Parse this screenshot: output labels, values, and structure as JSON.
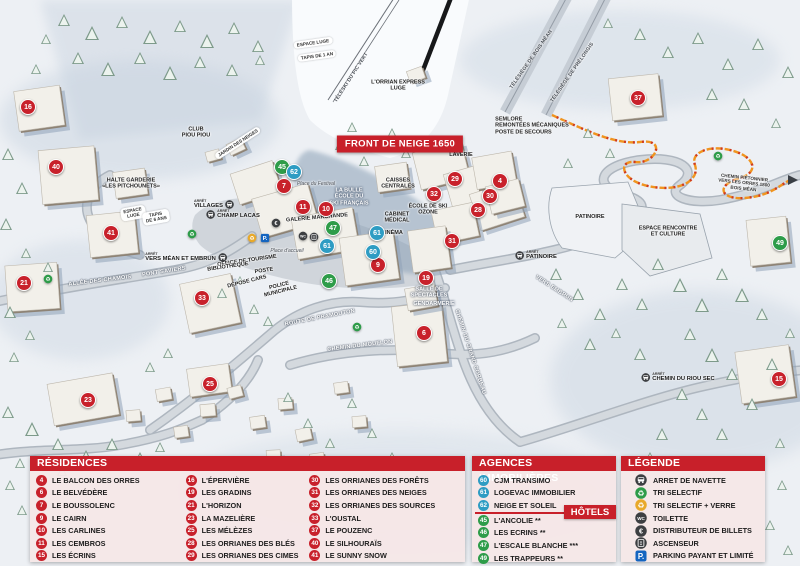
{
  "colors": {
    "residence": "#c8212b",
    "hotel": "#2e9c49",
    "agence": "#2e9cc3",
    "header_red": "#c8202a",
    "path_orange": "#f0941f"
  },
  "map": {
    "banner": "FRONT DE NEIGE 1650",
    "arret_label": "ARRÊT",
    "markers": [
      {
        "n": "16",
        "t": "residence",
        "x": 28,
        "y": 107
      },
      {
        "n": "40",
        "t": "residence",
        "x": 56,
        "y": 167
      },
      {
        "n": "41",
        "t": "residence",
        "x": 111,
        "y": 233
      },
      {
        "n": "21",
        "t": "residence",
        "x": 24,
        "y": 283
      },
      {
        "n": "23",
        "t": "residence",
        "x": 88,
        "y": 400
      },
      {
        "n": "25",
        "t": "residence",
        "x": 210,
        "y": 384
      },
      {
        "n": "33",
        "t": "residence",
        "x": 202,
        "y": 298
      },
      {
        "n": "7",
        "t": "residence",
        "x": 284,
        "y": 186
      },
      {
        "n": "11",
        "t": "residence",
        "x": 303,
        "y": 207
      },
      {
        "n": "10",
        "t": "residence",
        "x": 326,
        "y": 209
      },
      {
        "n": "9",
        "t": "residence",
        "x": 378,
        "y": 265
      },
      {
        "n": "19",
        "t": "residence",
        "x": 426,
        "y": 278
      },
      {
        "n": "6",
        "t": "residence",
        "x": 424,
        "y": 333
      },
      {
        "n": "31",
        "t": "residence",
        "x": 452,
        "y": 241
      },
      {
        "n": "32",
        "t": "residence",
        "x": 434,
        "y": 194
      },
      {
        "n": "29",
        "t": "residence",
        "x": 455,
        "y": 179
      },
      {
        "n": "28",
        "t": "residence",
        "x": 478,
        "y": 210
      },
      {
        "n": "30",
        "t": "residence",
        "x": 490,
        "y": 196
      },
      {
        "n": "4",
        "t": "residence",
        "x": 500,
        "y": 181
      },
      {
        "n": "37",
        "t": "residence",
        "x": 638,
        "y": 98
      },
      {
        "n": "15",
        "t": "residence",
        "x": 779,
        "y": 379
      },
      {
        "n": "45",
        "t": "hotel",
        "x": 282,
        "y": 167
      },
      {
        "n": "47",
        "t": "hotel",
        "x": 333,
        "y": 228
      },
      {
        "n": "46",
        "t": "hotel",
        "x": 329,
        "y": 281
      },
      {
        "n": "49",
        "t": "hotel",
        "x": 780,
        "y": 243
      },
      {
        "n": "62",
        "t": "agence",
        "x": 294,
        "y": 172
      },
      {
        "n": "61",
        "t": "agence",
        "x": 327,
        "y": 246
      },
      {
        "n": "61",
        "t": "agence",
        "x": 377,
        "y": 233
      },
      {
        "n": "60",
        "t": "agence",
        "x": 373,
        "y": 252
      }
    ],
    "labels": [
      {
        "text": "ESPACE LUGE",
        "x": 313,
        "y": 43,
        "r": -8,
        "cls": "pill"
      },
      {
        "text": "TAPIS DE 1 AN",
        "x": 317,
        "y": 56,
        "r": -8,
        "cls": "pill"
      },
      {
        "text": "TÉLÉSKI DU PIC VERT",
        "x": 352,
        "y": 78,
        "r": -57,
        "cls": "lift"
      },
      {
        "text": "L'ORRIAN EXPRESS\nLUGE",
        "x": 398,
        "y": 86,
        "r": 0,
        "cls": "dark"
      },
      {
        "text": "CLUB\nPIOU PIOU",
        "x": 196,
        "y": 133,
        "r": 0,
        "cls": "dark"
      },
      {
        "text": "JARDIN DES NEIGES",
        "x": 238,
        "y": 143,
        "r": -33,
        "cls": "pill"
      },
      {
        "text": "HALTE GARDERIE\n«LES PITCHOUNETS»",
        "x": 131,
        "y": 184,
        "r": 0,
        "cls": "dark"
      },
      {
        "text": "ESPACE\nLUGE",
        "x": 133,
        "y": 213,
        "r": -10,
        "cls": "pill"
      },
      {
        "text": "TAPIS\nDE 6 ANS",
        "x": 156,
        "y": 217,
        "r": -10,
        "cls": "pill"
      },
      {
        "text": "ALLÉE DES CHAMOIS",
        "x": 100,
        "y": 281,
        "r": -7,
        "cls": "road"
      },
      {
        "text": "PONT SAVIERS",
        "x": 164,
        "y": 272,
        "r": -9,
        "cls": "road"
      },
      {
        "text": "Place du Festival",
        "x": 316,
        "y": 185,
        "r": 0,
        "cls": "place"
      },
      {
        "text": "LA BULLE\nÉCOLE DU\nSKI FRANÇAIS",
        "x": 349,
        "y": 197,
        "r": 0,
        "cls": "white"
      },
      {
        "text": "GALERIE MARCHANDE",
        "x": 317,
        "y": 218,
        "r": -5,
        "cls": "dark"
      },
      {
        "text": "CAISSES\nCENTRALES",
        "x": 398,
        "y": 184,
        "r": 0,
        "cls": "dark"
      },
      {
        "text": "LAVERIE",
        "x": 461,
        "y": 155,
        "r": 0,
        "cls": "dark"
      },
      {
        "text": "ÉCOLE DE SKI\nOZONE",
        "x": 428,
        "y": 210,
        "r": 0,
        "cls": "dark"
      },
      {
        "text": "CABINET\nMÉDICAL",
        "x": 397,
        "y": 218,
        "r": 0,
        "cls": "dark"
      },
      {
        "text": "CINÉMA",
        "x": 392,
        "y": 233,
        "r": 0,
        "cls": "dark"
      },
      {
        "text": "Place d'accueil",
        "x": 287,
        "y": 252,
        "r": 0,
        "cls": "place"
      },
      {
        "text": "OFFICE DE TOURISME",
        "x": 247,
        "y": 261,
        "r": -8,
        "cls": "dark"
      },
      {
        "text": "BIBLIOTHÈQUE",
        "x": 228,
        "y": 267,
        "r": -8,
        "cls": "dark"
      },
      {
        "text": "POSTE",
        "x": 264,
        "y": 271,
        "r": -8,
        "cls": "dark"
      },
      {
        "text": "DÉPOSE CARS",
        "x": 247,
        "y": 282,
        "r": -14,
        "cls": "dark"
      },
      {
        "text": "POLICE\nMUNICIPALE",
        "x": 280,
        "y": 289,
        "r": -14,
        "cls": "dark"
      },
      {
        "text": "ROUTE DE PRAMOUTON",
        "x": 320,
        "y": 318,
        "r": -11,
        "cls": "road"
      },
      {
        "text": "CHEMIN DU MOUFLON",
        "x": 360,
        "y": 346,
        "r": -7,
        "cls": "road"
      },
      {
        "text": "CHEMIN DU GRAND CORBEAU",
        "x": 470,
        "y": 352,
        "r": 72,
        "cls": "road"
      },
      {
        "text": "SALLE DE\nSPECTACLES",
        "x": 429,
        "y": 293,
        "r": 0,
        "cls": "white"
      },
      {
        "text": "GENDARMERIE",
        "x": 434,
        "y": 304,
        "r": 0,
        "cls": "white"
      },
      {
        "text": "SEMLORE\nREMONTÉES MÉCANIQUES\nPOSTE DE SECOURS",
        "x": 532,
        "y": 126,
        "r": 0,
        "cls": "dark left"
      },
      {
        "text": "TÉLÉSIÈGE DE BOIS MÉAN",
        "x": 532,
        "y": 60,
        "r": -55,
        "cls": "lift"
      },
      {
        "text": "TÉLÉSIÈGE DE PRÉLONGIS",
        "x": 573,
        "y": 73,
        "r": -55,
        "cls": "lift"
      },
      {
        "text": "PATINOIRE",
        "x": 590,
        "y": 217,
        "r": 0,
        "cls": "dark"
      },
      {
        "text": "ESPACE RENCONTRE\nET CULTURE",
        "x": 668,
        "y": 232,
        "r": 0,
        "cls": "dark"
      },
      {
        "text": "VERS EMBRUN",
        "x": 554,
        "y": 289,
        "r": 33,
        "cls": "road"
      },
      {
        "text": "CHEMIN PIÉTONNIER\nVERS LES ORRES 1800\nBOIS MÉAN",
        "x": 744,
        "y": 183,
        "r": 6,
        "cls": "tiny"
      }
    ],
    "stops": [
      {
        "label": "VILLAGES",
        "x": 214,
        "y": 205,
        "textSide": "left"
      },
      {
        "label": "CHAMP LACAS",
        "x": 233,
        "y": 215,
        "textSide": "right"
      },
      {
        "label": "VERS MÉAN ET EMBRUN",
        "x": 186,
        "y": 258,
        "textSide": "left"
      },
      {
        "label": "PATINOIRE",
        "x": 536,
        "y": 256,
        "textSide": "right"
      },
      {
        "label": "CHEMIN DU RIOU SEC",
        "x": 678,
        "y": 378,
        "textSide": "right"
      }
    ],
    "icons": [
      {
        "k": "recycle-green",
        "x": 48,
        "y": 279
      },
      {
        "k": "recycle-green",
        "x": 192,
        "y": 234
      },
      {
        "k": "recycle-green",
        "x": 357,
        "y": 327
      },
      {
        "k": "recycle-green",
        "x": 718,
        "y": 156
      },
      {
        "k": "recycle-yellow",
        "x": 252,
        "y": 238
      },
      {
        "k": "parking",
        "x": 265,
        "y": 238
      },
      {
        "k": "euro",
        "x": 276,
        "y": 223
      },
      {
        "k": "toilet",
        "x": 303,
        "y": 236
      },
      {
        "k": "elevator",
        "x": 314,
        "y": 237
      }
    ]
  },
  "panels": {
    "residences": {
      "title": "RÉSIDENCES",
      "items": [
        {
          "n": "4",
          "label": "LE BALCON DES ORRES"
        },
        {
          "n": "6",
          "label": "LE BELVÉDÈRE"
        },
        {
          "n": "7",
          "label": "LE BOUSSOLENC"
        },
        {
          "n": "9",
          "label": "LE CAIRN"
        },
        {
          "n": "10",
          "label": "LES CARLINES"
        },
        {
          "n": "11",
          "label": "LES CEMBROS"
        },
        {
          "n": "15",
          "label": "LES ÉCRINS"
        },
        {
          "n": "16",
          "label": "L'ÉPERVIÈRE"
        },
        {
          "n": "19",
          "label": "LES GRADINS"
        },
        {
          "n": "21",
          "label": "L'HORIZON"
        },
        {
          "n": "23",
          "label": "LA MAZELIÈRE"
        },
        {
          "n": "25",
          "label": "LES MÉLÈZES"
        },
        {
          "n": "28",
          "label": "LES ORRIANES DES BLÉS"
        },
        {
          "n": "29",
          "label": "LES ORRIANES DES CIMES"
        },
        {
          "n": "30",
          "label": "LES ORRIANES DES FORÊTS"
        },
        {
          "n": "31",
          "label": "LES ORRIANES DES NEIGES"
        },
        {
          "n": "32",
          "label": "LES ORRIANES DES SOURCES"
        },
        {
          "n": "33",
          "label": "L'OUSTAL"
        },
        {
          "n": "37",
          "label": "LE POUZENC"
        },
        {
          "n": "40",
          "label": "LE SILHOURAÏS"
        },
        {
          "n": "41",
          "label": "LE SUNNY SNOW"
        }
      ]
    },
    "agences": {
      "title": "AGENCES IMMOBILIÈRES",
      "items": [
        {
          "n": "60",
          "label": "CJM TRANSIMO"
        },
        {
          "n": "61",
          "label": "LOGEVAC IMMOBILIER"
        },
        {
          "n": "62",
          "label": "NEIGE ET SOLEIL"
        }
      ]
    },
    "hotels": {
      "title": "HÔTELS",
      "items": [
        {
          "n": "45",
          "label": "L'ANCOLIE **"
        },
        {
          "n": "46",
          "label": "LES ECRINS **"
        },
        {
          "n": "47",
          "label": "L'ESCALE BLANCHE ***"
        },
        {
          "n": "49",
          "label": "LES TRAPPEURS **"
        }
      ]
    },
    "legende": {
      "title": "LÉGENDE",
      "items": [
        {
          "icon": "bus",
          "label": "ARRET DE NAVETTE"
        },
        {
          "icon": "recycle-green",
          "label": "TRI SELECTIF"
        },
        {
          "icon": "recycle-yellow",
          "label": "TRI SELECTIF + VERRE"
        },
        {
          "icon": "toilet",
          "label": "TOILETTE"
        },
        {
          "icon": "euro",
          "label": "DISTRIBUTEUR DE BILLETS"
        },
        {
          "icon": "elevator",
          "label": "ASCENSEUR"
        },
        {
          "icon": "parking",
          "label": "PARKING PAYANT ET LIMITÉ"
        }
      ]
    }
  }
}
